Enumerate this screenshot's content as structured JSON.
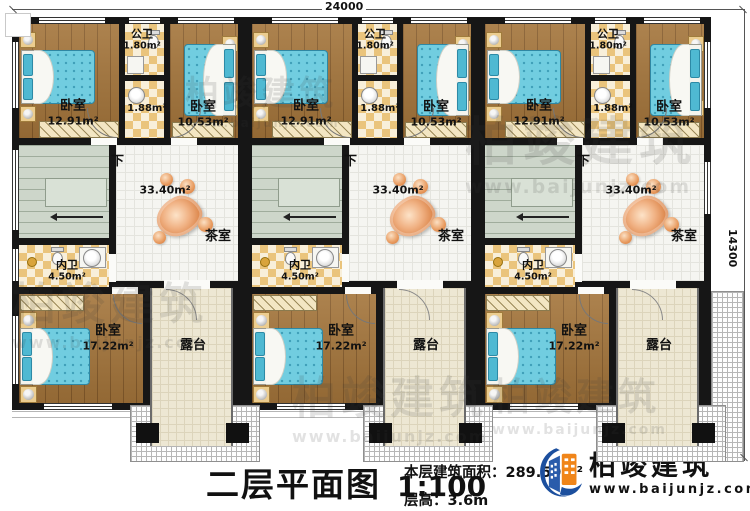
{
  "plan": {
    "title": "二层平面图",
    "scale": "1:100",
    "area_label": "本层建筑面积：",
    "area_value": "289.59m²",
    "floor_height_label": "层高：",
    "floor_height_value": "3.6m"
  },
  "dimensions": {
    "top": "24000",
    "right": "14300"
  },
  "brand": {
    "name": "柏竣建筑",
    "url": "www.baijunjz.com"
  },
  "watermark": {
    "name": "柏竣建筑",
    "url": "www.baijunjz.com"
  },
  "rooms": {
    "bedroom_front_left": {
      "name": "卧室",
      "area": "12.91m²"
    },
    "bedroom_front_right": {
      "name": "卧室",
      "area": "10.53m²"
    },
    "bedroom_back": {
      "name": "卧室",
      "area": "17.22m²"
    },
    "public_bath": {
      "name": "公卫",
      "area": "1.80m²"
    },
    "bath_anteroom_area": "1.88m²",
    "private_bath": {
      "name": "内卫",
      "area": "4.50m²"
    },
    "tea_room": {
      "name": "茶室",
      "area": "33.40m²"
    },
    "terrace": {
      "name": "露台"
    },
    "stairs_down": "下"
  },
  "colors": {
    "wall": "#161616",
    "wood_floor": "#a3743a",
    "bed": "#71cde0",
    "bath_checker": "#eac47c",
    "stair_floor": "#cdd6ca",
    "terrace_floor": "#ede7d3",
    "decor_orange": "#d97f42",
    "brand_blue": "#1c4f9e",
    "brand_orange": "#f08519"
  }
}
